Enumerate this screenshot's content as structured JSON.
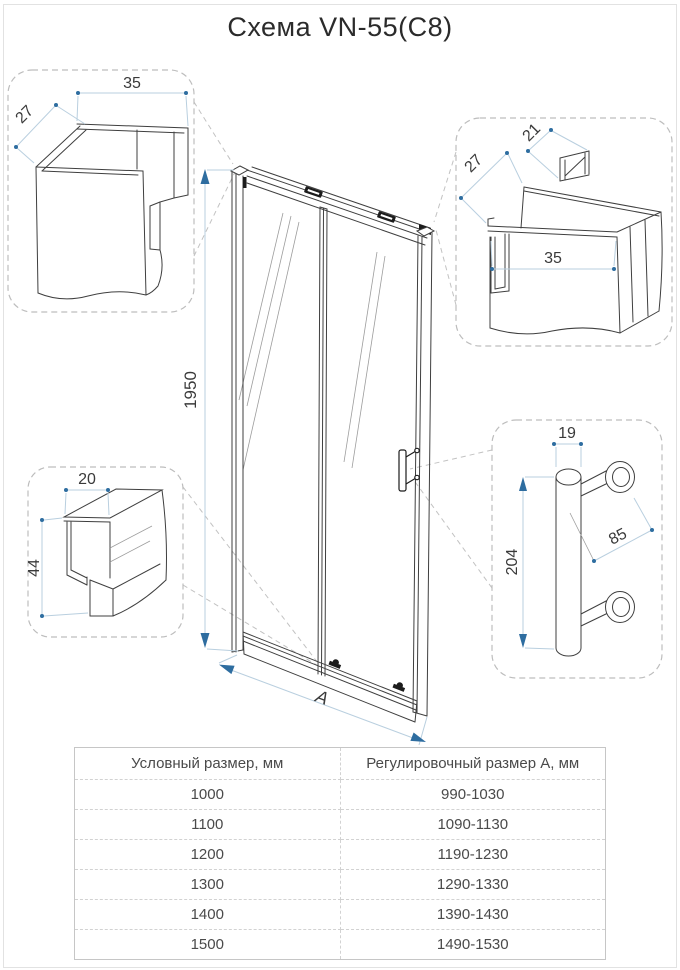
{
  "title": "Схема VN-55(C8)",
  "colors": {
    "dimension_accent": "#2e6da0",
    "dimension_line": "#b9cfdf",
    "line_art": "#3f3f3f",
    "callout_dash": "#bdbdbd",
    "table_border": "#c6c6c6",
    "text": "#3a3a3a"
  },
  "main_view": {
    "height_mm": "1950",
    "width_label": "A"
  },
  "details": {
    "wall_profile": {
      "width_mm": "35",
      "depth_mm": "27"
    },
    "top_profile": {
      "depth_mm": "27",
      "tab_mm": "21",
      "width_mm": "35"
    },
    "bottom_profile": {
      "width_mm": "20",
      "height_mm": "44"
    },
    "handle": {
      "diameter_mm": "19",
      "length_mm": "204",
      "span_mm": "85"
    }
  },
  "table": {
    "headers": [
      "Условный размер, мм",
      "Регулировочный размер А, мм"
    ],
    "rows": [
      [
        "1000",
        "990-1030"
      ],
      [
        "1100",
        "1090-1130"
      ],
      [
        "1200",
        "1190-1230"
      ],
      [
        "1300",
        "1290-1330"
      ],
      [
        "1400",
        "1390-1430"
      ],
      [
        "1500",
        "1490-1530"
      ]
    ]
  }
}
